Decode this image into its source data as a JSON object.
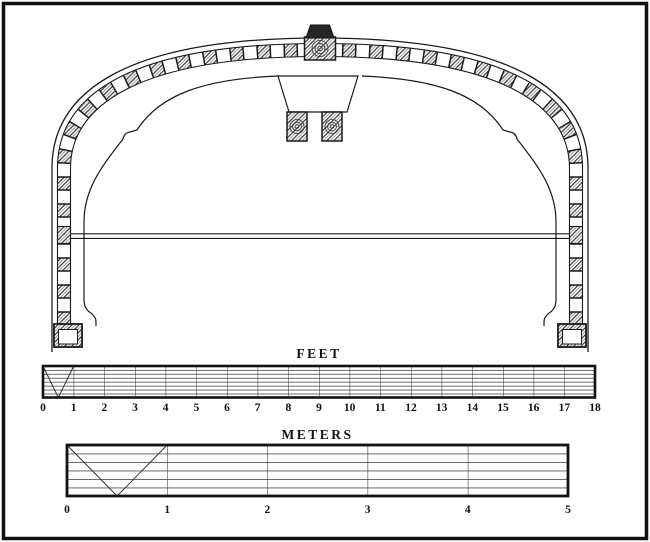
{
  "figure": {
    "kind": "technical line drawing",
    "subject": "arched cross-section with hatched timber blocks, keystone, central ridge assembly, tie rod and square feet"
  },
  "scales": {
    "feet": {
      "label": "FEET",
      "min": 0,
      "max": 18,
      "ticks": [
        "0",
        "1",
        "2",
        "3",
        "4",
        "5",
        "6",
        "7",
        "8",
        "9",
        "10",
        "11",
        "12",
        "13",
        "14",
        "15",
        "16",
        "17",
        "18"
      ]
    },
    "meters": {
      "label": "METERS",
      "min": 0,
      "max": 5,
      "ticks": [
        "0",
        "1",
        "2",
        "3",
        "4",
        "5"
      ]
    }
  },
  "colors": {
    "ink": "#1a1a1a",
    "paper": "#ffffff",
    "grid_line": "#555555",
    "hatch_line": "#3a3a3a"
  }
}
